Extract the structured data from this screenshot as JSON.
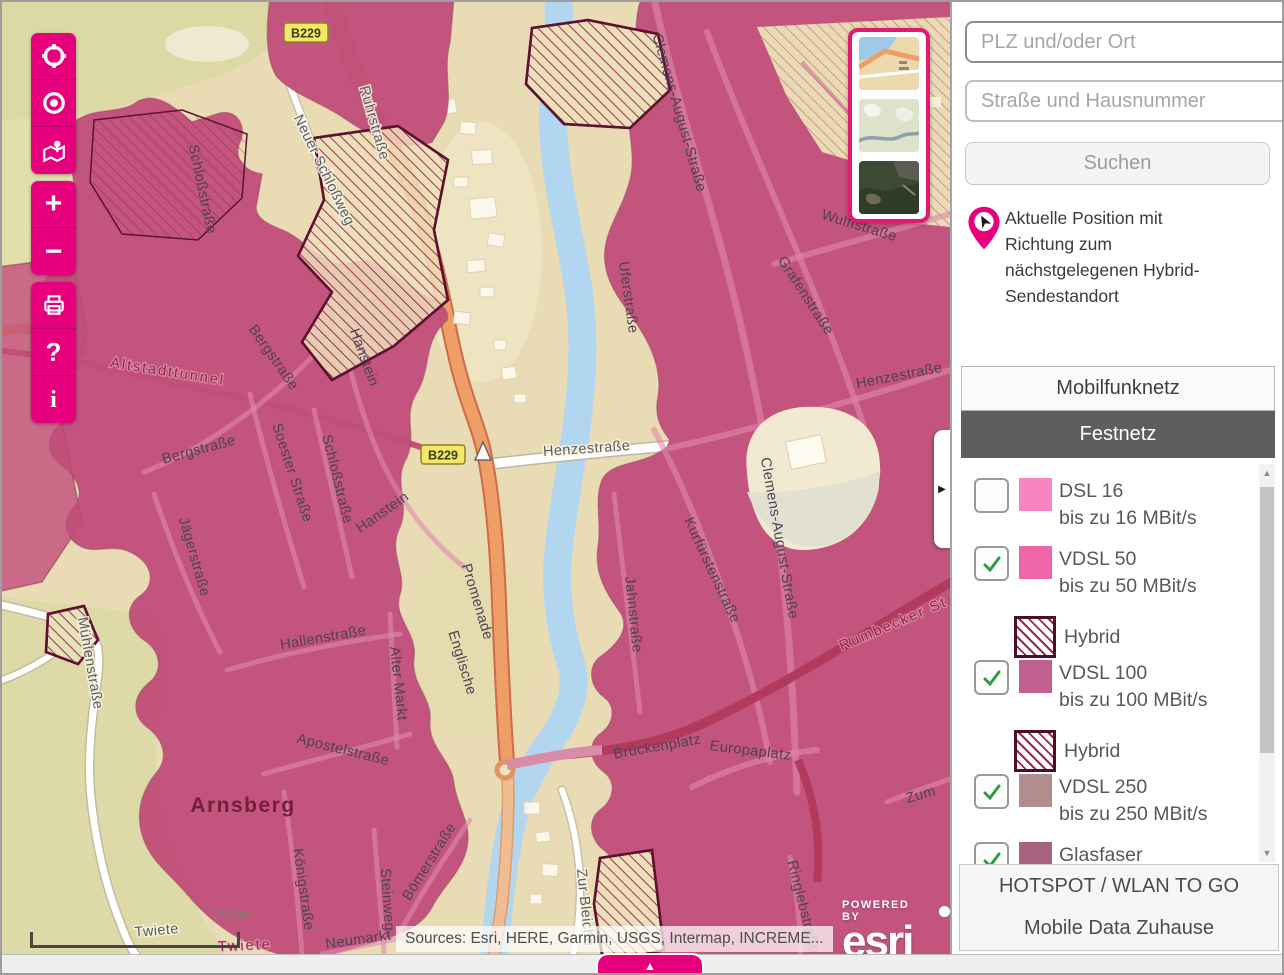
{
  "colors": {
    "accent": "#e6007e",
    "overlay_rose": "#c14f7a",
    "tab_active_bg": "#605d5e",
    "hybrid_border": "#4f0c29"
  },
  "toolbar": {
    "buttons": [
      {
        "name": "zoom-extent-button",
        "icon": "crosshair-icon",
        "glyph": ""
      },
      {
        "name": "locate-button",
        "icon": "bullseye-icon",
        "glyph": ""
      },
      {
        "name": "overview-map-button",
        "icon": "map-pin-icon",
        "glyph": ""
      },
      {
        "name": "zoom-in-button",
        "icon": "plus-icon",
        "glyph": "+"
      },
      {
        "name": "zoom-out-button",
        "icon": "minus-icon",
        "glyph": "−"
      },
      {
        "name": "print-button",
        "icon": "printer-icon",
        "glyph": ""
      },
      {
        "name": "help-button",
        "icon": "question-icon",
        "glyph": "?"
      },
      {
        "name": "info-button",
        "icon": "info-icon",
        "glyph": "i"
      }
    ]
  },
  "basemap_selector": {
    "thumbnails": [
      {
        "name": "street-basemap"
      },
      {
        "name": "topo-basemap"
      },
      {
        "name": "satellite-basemap"
      }
    ]
  },
  "search": {
    "plz_placeholder": "PLZ und/oder Ort",
    "street_placeholder": "Straße und Hausnummer",
    "submit_label": "Suchen"
  },
  "position_info": {
    "text": "Aktuelle Position mit Richtung zum nächstgelegenen Hybrid-Sendestandort"
  },
  "tabs": [
    {
      "label": "Mobilfunknetz",
      "active": false
    },
    {
      "label": "Festnetz",
      "active": true
    }
  ],
  "legend": {
    "items": [
      {
        "label": "DSL 16",
        "sublabel": "bis zu 16 MBit/s",
        "checked": false,
        "color": "#f884c0",
        "hybrid": false
      },
      {
        "label": "VDSL 50",
        "sublabel": "bis zu 50 MBit/s",
        "checked": true,
        "color": "#ec66a8",
        "hybrid": true,
        "hybrid_label": "Hybrid"
      },
      {
        "label": "VDSL 100",
        "sublabel": "bis zu 100 MBit/s",
        "checked": true,
        "color": "#c05f90",
        "hybrid": true,
        "hybrid_label": "Hybrid"
      },
      {
        "label": "VDSL 250",
        "sublabel": "bis zu 250 MBit/s",
        "checked": true,
        "color": "#b18d8d",
        "hybrid": false
      },
      {
        "label": "Glasfaser",
        "sublabel": "",
        "checked": true,
        "color": "#a8647f",
        "hybrid": false
      }
    ]
  },
  "footer_buttons": [
    {
      "label": "HOTSPOT / WLAN TO GO"
    },
    {
      "label": "Mobile Data Zuhause"
    }
  ],
  "map": {
    "attribution": "Sources: Esri, HERE, Garmin, USGS, Intermap, INCREME...",
    "powered_by": "POWERED BY",
    "esri_label": "esri",
    "scale_label": "200m",
    "sheet_toggle_glyph": "▲",
    "collapse_glyph": "▶",
    "shields": [
      {
        "text": "B229",
        "x": 304,
        "y": 31
      },
      {
        "text": "B229",
        "x": 441,
        "y": 453
      }
    ],
    "street_labels": [
      {
        "text": "Ruhrstraße",
        "x": 368,
        "y": 122,
        "rot": 74,
        "style": "road"
      },
      {
        "text": "Neuer Schloßweg",
        "x": 318,
        "y": 170,
        "rot": 64,
        "style": "road"
      },
      {
        "text": "Schloßstraße",
        "x": 196,
        "y": 188,
        "rot": 78,
        "style": "ovl"
      },
      {
        "text": "Clemens-August-Straße",
        "x": 673,
        "y": 112,
        "rot": 74,
        "style": "ovl"
      },
      {
        "text": "Grafenstraße",
        "x": 800,
        "y": 296,
        "rot": 57,
        "style": "ovl"
      },
      {
        "text": "Wulffstraße",
        "x": 856,
        "y": 228,
        "rot": 17,
        "style": "ovl"
      },
      {
        "text": "Henzestraße",
        "x": 898,
        "y": 378,
        "rot": -11,
        "style": "ovl"
      },
      {
        "text": "Uferstraße",
        "x": 622,
        "y": 296,
        "rot": 82,
        "style": "ovl"
      },
      {
        "text": "Altstadttunnel",
        "x": 165,
        "y": 374,
        "rot": 9,
        "style": "red"
      },
      {
        "text": "Bergstraße",
        "x": 268,
        "y": 358,
        "rot": 55,
        "style": "ovl"
      },
      {
        "text": "Bergstraße",
        "x": 198,
        "y": 452,
        "rot": -15,
        "style": "ovl"
      },
      {
        "text": "Soester Straße",
        "x": 286,
        "y": 472,
        "rot": 72,
        "style": "ovl"
      },
      {
        "text": "Schloßstraße",
        "x": 331,
        "y": 478,
        "rot": 76,
        "style": "ovl"
      },
      {
        "text": "Hanstein",
        "x": 358,
        "y": 357,
        "rot": 70,
        "style": "ovl"
      },
      {
        "text": "Hanstein",
        "x": 383,
        "y": 514,
        "rot": -35,
        "style": "ovl"
      },
      {
        "text": "Jägerstraße",
        "x": 188,
        "y": 556,
        "rot": 74,
        "style": "ovl"
      },
      {
        "text": "Mühlenstraße",
        "x": 84,
        "y": 662,
        "rot": 80,
        "style": "road"
      },
      {
        "text": "Hallenstraße",
        "x": 322,
        "y": 640,
        "rot": -10,
        "style": "ovl"
      },
      {
        "text": "Alter Markt",
        "x": 392,
        "y": 682,
        "rot": 84,
        "style": "ovl"
      },
      {
        "text": "Apostelstraße",
        "x": 340,
        "y": 752,
        "rot": 14,
        "style": "ovl"
      },
      {
        "text": "Arnsberg",
        "x": 241,
        "y": 810,
        "rot": 0,
        "style": "city"
      },
      {
        "text": "Königstraße",
        "x": 297,
        "y": 888,
        "rot": 82,
        "style": "ovl"
      },
      {
        "text": "Steinweg",
        "x": 381,
        "y": 898,
        "rot": 86,
        "style": "ovl"
      },
      {
        "text": "Bömerstraße",
        "x": 431,
        "y": 862,
        "rot": -58,
        "style": "ovl"
      },
      {
        "text": "Neumarkt",
        "x": 357,
        "y": 942,
        "rot": -8,
        "style": "ovl"
      },
      {
        "text": "Twiete",
        "x": 243,
        "y": 948,
        "rot": -3,
        "style": "red"
      },
      {
        "text": "Twiete",
        "x": 155,
        "y": 933,
        "rot": -5,
        "style": "road"
      },
      {
        "text": "Henzestraße",
        "x": 585,
        "y": 451,
        "rot": -4,
        "style": "road"
      },
      {
        "text": "Kurfürstenstraße",
        "x": 706,
        "y": 570,
        "rot": 65,
        "style": "ovl"
      },
      {
        "text": "Clemens-August-Straße",
        "x": 773,
        "y": 537,
        "rot": 80,
        "style": "ovl"
      },
      {
        "text": "Jahnstraße",
        "x": 627,
        "y": 613,
        "rot": 84,
        "style": "ovl"
      },
      {
        "text": "Rumbecker St",
        "x": 893,
        "y": 626,
        "rot": -23,
        "style": "red"
      },
      {
        "text": "Brückenplatz",
        "x": 656,
        "y": 749,
        "rot": -10,
        "style": "ovl"
      },
      {
        "text": "Europaplatz",
        "x": 748,
        "y": 753,
        "rot": 7,
        "style": "ovl"
      },
      {
        "text": "Zum",
        "x": 920,
        "y": 797,
        "rot": -16,
        "style": "ovl"
      },
      {
        "text": "Ringlebstraße",
        "x": 797,
        "y": 906,
        "rot": 76,
        "style": "ovl"
      },
      {
        "text": "Englische",
        "x": 456,
        "y": 662,
        "rot": 73,
        "style": "ovl"
      },
      {
        "text": "Promenade",
        "x": 471,
        "y": 601,
        "rot": 73,
        "style": "ovl"
      },
      {
        "text": "Zur Bleiche",
        "x": 579,
        "y": 906,
        "rot": 84,
        "style": "road"
      }
    ]
  }
}
